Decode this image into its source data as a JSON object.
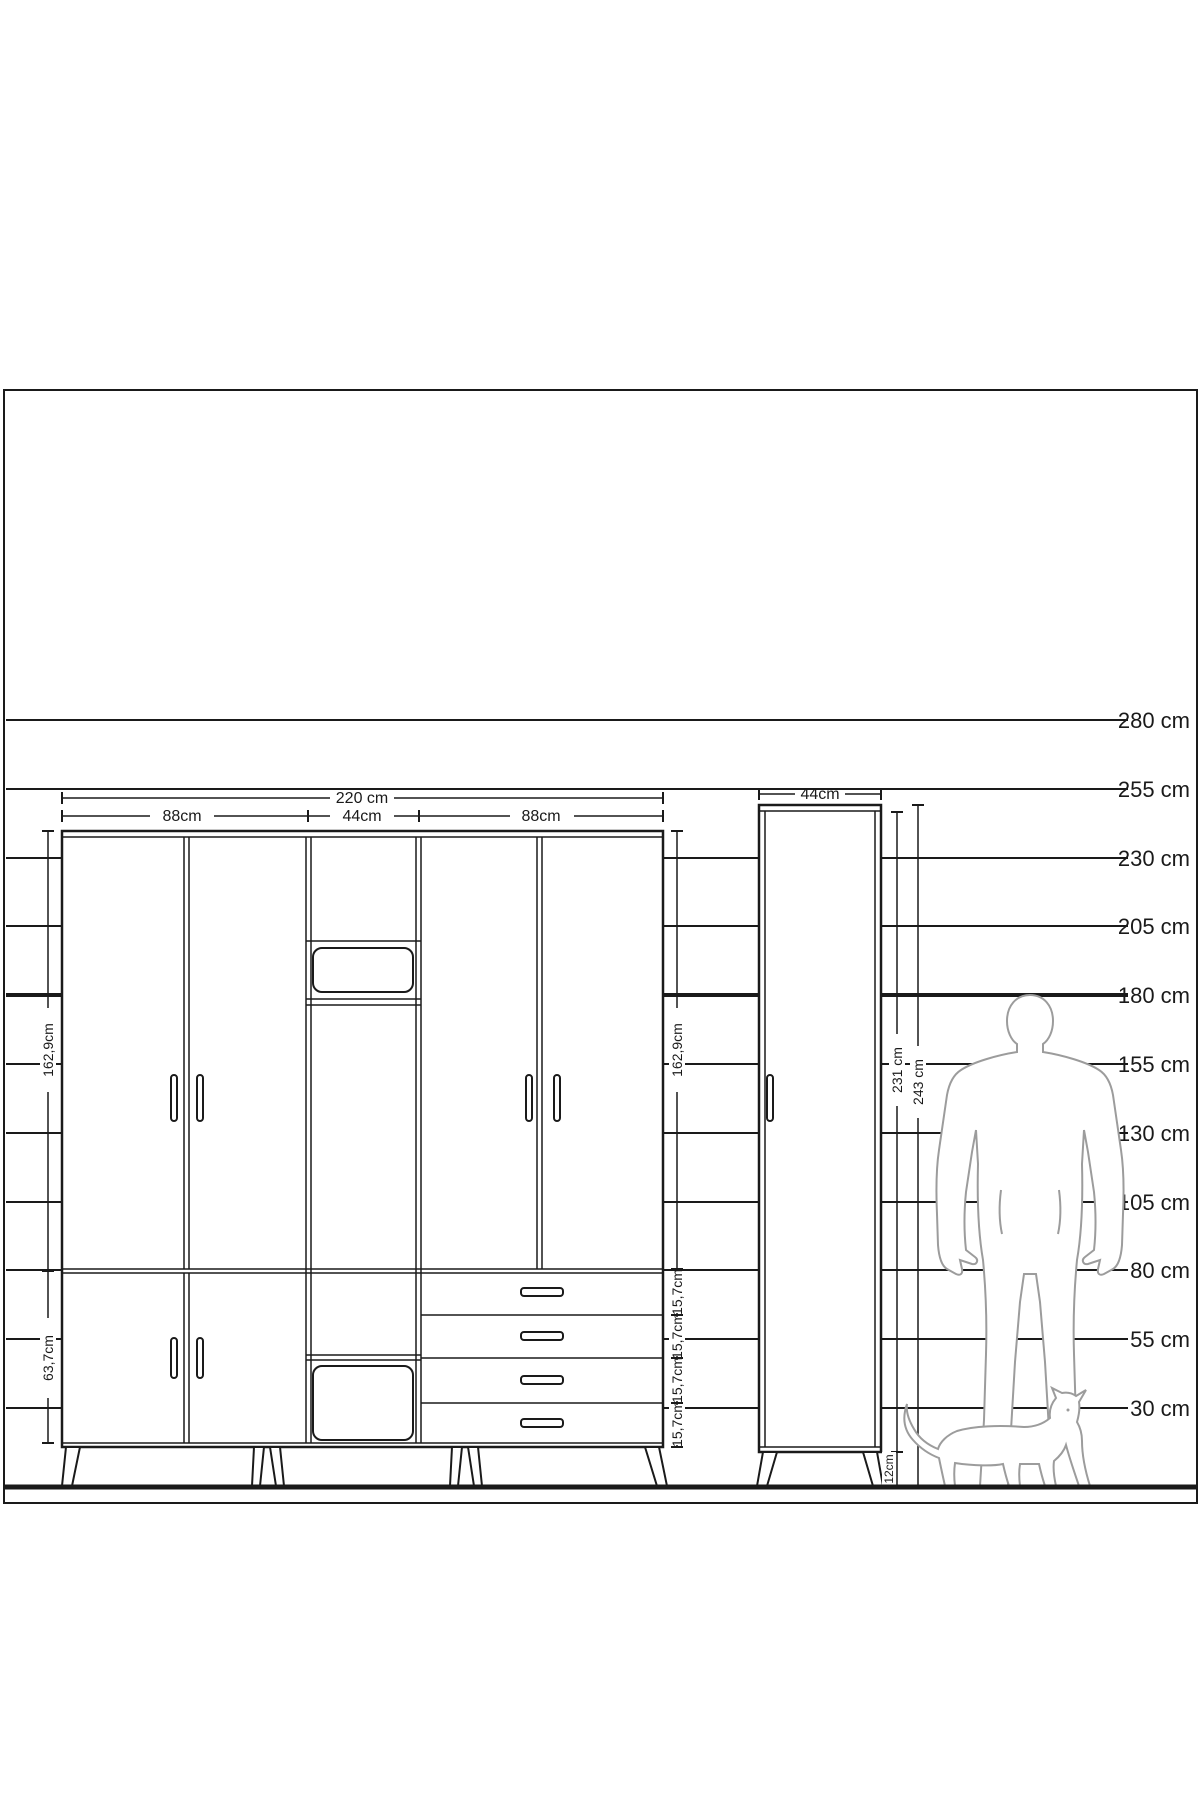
{
  "figure": {
    "type": "furniture-dimension-diagram",
    "colors": {
      "line": "#1a1a1a",
      "figure_outline": "#9c9c9c",
      "background": "#ffffff"
    },
    "scale": {
      "unit": "cm",
      "labels": [
        "280 cm",
        "255 cm",
        "230 cm",
        "205 cm",
        "180 cm",
        "155 cm",
        "130 cm",
        "105 cm",
        "80 cm",
        "55 cm",
        "30 cm"
      ],
      "values": [
        280,
        255,
        230,
        205,
        180,
        155,
        130,
        105,
        80,
        55,
        30
      ],
      "bold_value": 180
    },
    "wardrobe": {
      "width_total": "220 cm",
      "widths": [
        "88cm",
        "44cm",
        "88cm"
      ],
      "left_heights": {
        "upper": "162,9cm",
        "lower": "63,7cm"
      },
      "right_heights": {
        "upper": "162,9cm",
        "drawers": [
          "15,7cm",
          "15,7cm",
          "15,7cm",
          "15,7cm"
        ]
      },
      "dimensions_cm": {
        "total_width": 220,
        "sections": [
          88,
          44,
          88
        ],
        "upper_doors": 162.9,
        "lower_doors": 63.7,
        "drawer": 15.7
      }
    },
    "side_cabinet": {
      "width": "44cm",
      "body_height": "231 cm",
      "total_height": "243 cm",
      "leg_height": "12cm",
      "dimensions_cm": {
        "width": 44,
        "body_height": 231,
        "total_height": 243,
        "legs": 12
      }
    }
  }
}
